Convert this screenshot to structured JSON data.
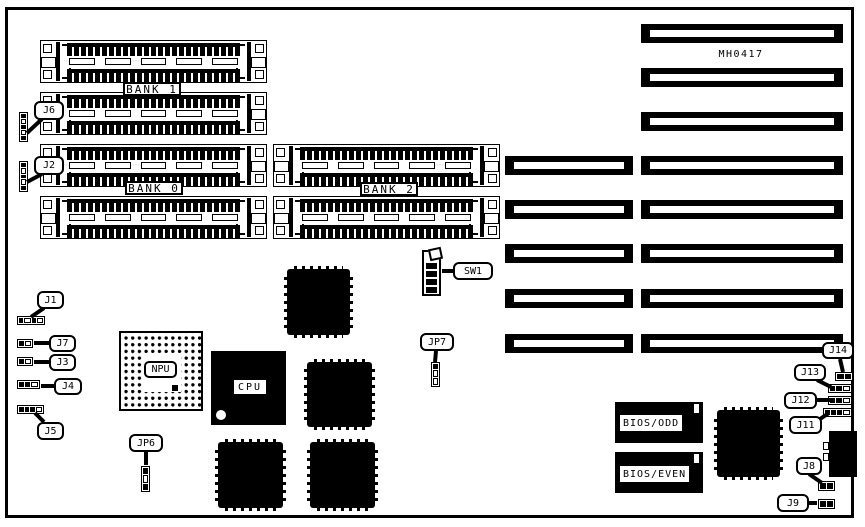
{
  "diagram_title": "MH0417",
  "colors": {
    "ink": "#000000",
    "paper": "#ffffff"
  },
  "labels": {
    "part_number": "MH0417",
    "bank0": "BANK 0",
    "bank1": "BANK 1",
    "bank2": "BANK 2",
    "npu": "NPU",
    "cpu": "CPU",
    "bios_odd": "BIOS/ODD",
    "bios_even": "BIOS/EVEN",
    "sw1": "SW1",
    "jp6": "JP6",
    "jp7": "JP7",
    "j1": "J1",
    "j2": "J2",
    "j3": "J3",
    "j4": "J4",
    "j5": "J5",
    "j6": "J6",
    "j7": "J7",
    "j8": "J8",
    "j9": "J9",
    "j11": "J11",
    "j12": "J12",
    "j13": "J13",
    "j14": "J14"
  },
  "components": {
    "memory_banks": [
      "BANK 0",
      "BANK 1",
      "BANK 2"
    ],
    "simm_socket_rows": 6,
    "expansion_slots_total": 8,
    "expansion_slots_two_segment": 5,
    "expansion_slots_one_segment": 3,
    "chips": [
      "NPU",
      "CPU",
      "BIOS/ODD",
      "BIOS/EVEN"
    ],
    "jumpers": [
      "J1",
      "J2",
      "J3",
      "J4",
      "J5",
      "J6",
      "J7",
      "J8",
      "J9",
      "J11",
      "J12",
      "J13",
      "J14",
      "JP6",
      "JP7"
    ],
    "dip_switch": "SW1"
  }
}
